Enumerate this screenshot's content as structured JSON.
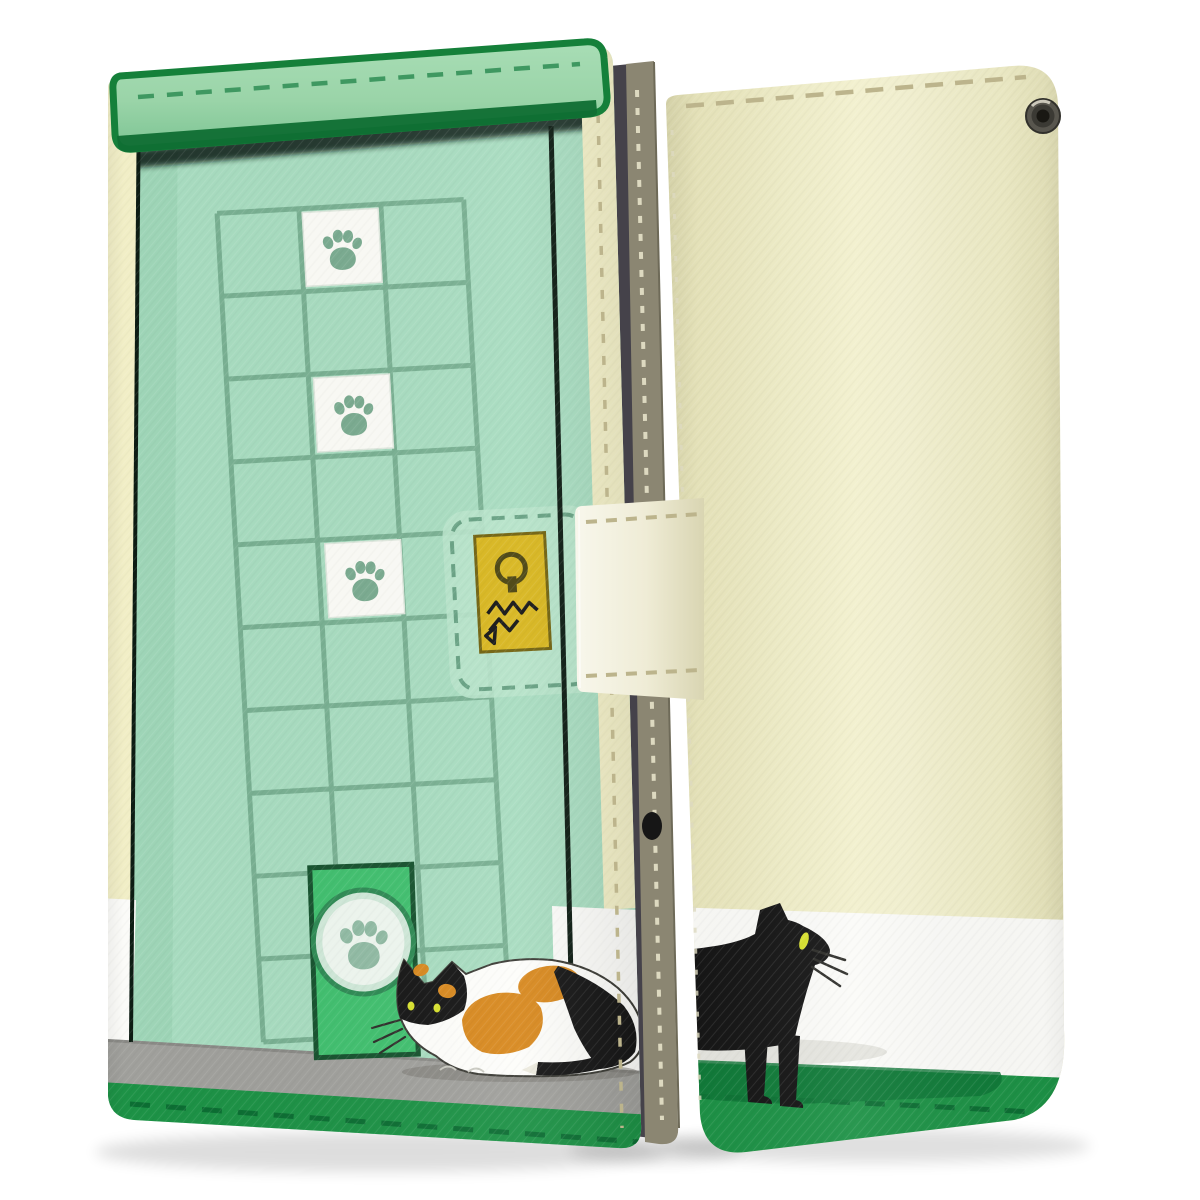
{
  "scene": {
    "type": "product-photo",
    "subject": "Wallet-style flip phone case with cat design, shown closed: front cover (left) and back cover (right)",
    "background": "#ffffff"
  },
  "front_case": {
    "motif": "Mint green cat door: top awning bar, panel grid with three white paw-print tiles, printed clasp tab with gold keyhole plate and cat-scratch marks, green cat-flap door with paw emblem, calico cat sitting on grey doorstep, green grass band",
    "paw_tiles": 3
  },
  "back_case": {
    "motif": "Cream wall with white baseboard band and green grass band, walking black cat with yellow eye and whiskers, metal strap eyelet, stitched seams"
  },
  "hardware": {
    "strap": "cream magnetic clasp strap across spine",
    "spine": "khaki stitched spine with phone edge visible",
    "eyelet": "gunmetal strap eyelet"
  },
  "colors": {
    "background": "#ffffff",
    "mint": "#a8dcc0",
    "mintShade": "#96cfae",
    "mintTab": "#b7e3ca",
    "grid": "#76ad8f",
    "flapLight": "#a8ddb5",
    "flapMid": "#9ad4a8",
    "flapDeep": "#7dc494",
    "flapEdge": "#15803a",
    "flapLip": "#0f6e33",
    "flapStitch": "#3f9861",
    "creamEdge": "#f1eec6",
    "backShade": "#d8d5ab",
    "backMid": "#f0eec8",
    "backLight": "#f3f1d0",
    "whiteBand": "#fbfbf8",
    "grayStep": "#a0a09c",
    "grayStepEdge": "#8a8a86",
    "grass": "#1d9246",
    "grassDark": "#0c6e33",
    "grassShadow": "#0e7636",
    "doorGreen": "#41c06f",
    "doorEdge": "#17532f",
    "doorCircle": "#cfe8d8",
    "doorCircleInner": "#eef6ef",
    "doorRing": "#2f8b55",
    "pawTile": "#fbfbf6",
    "paw": "#7aab90",
    "pawDoor": "#91bba4",
    "gold": "#d8b61e",
    "goldEdge": "#71620e",
    "keyhole": "#4a430e",
    "black": "#161616",
    "orange": "#d8891f",
    "eyeYellow": "#d9e22e",
    "khaki": "#8b8672",
    "khakiEdge": "#6e6a58",
    "phoneDark": "#45424a",
    "stitchCream": "#bcb48c",
    "stitchLight": "#ddd9c0",
    "outlineDark": "#0d1c13",
    "whiskerDark": "#2e2e2a",
    "calicoWhite": "#fdfdfa",
    "calicoOutline": "#3b3b35",
    "tailTip": "#eceade",
    "strapLight": "#f8f7ec",
    "strapDark": "#d9d5b2",
    "eyeletOuter": "#58564e",
    "eyeletMid": "#3b3a34",
    "eyeletInner": "#191813",
    "eyeletRim": "#31302b",
    "eyeletHighlight": "#d8d5c6"
  }
}
